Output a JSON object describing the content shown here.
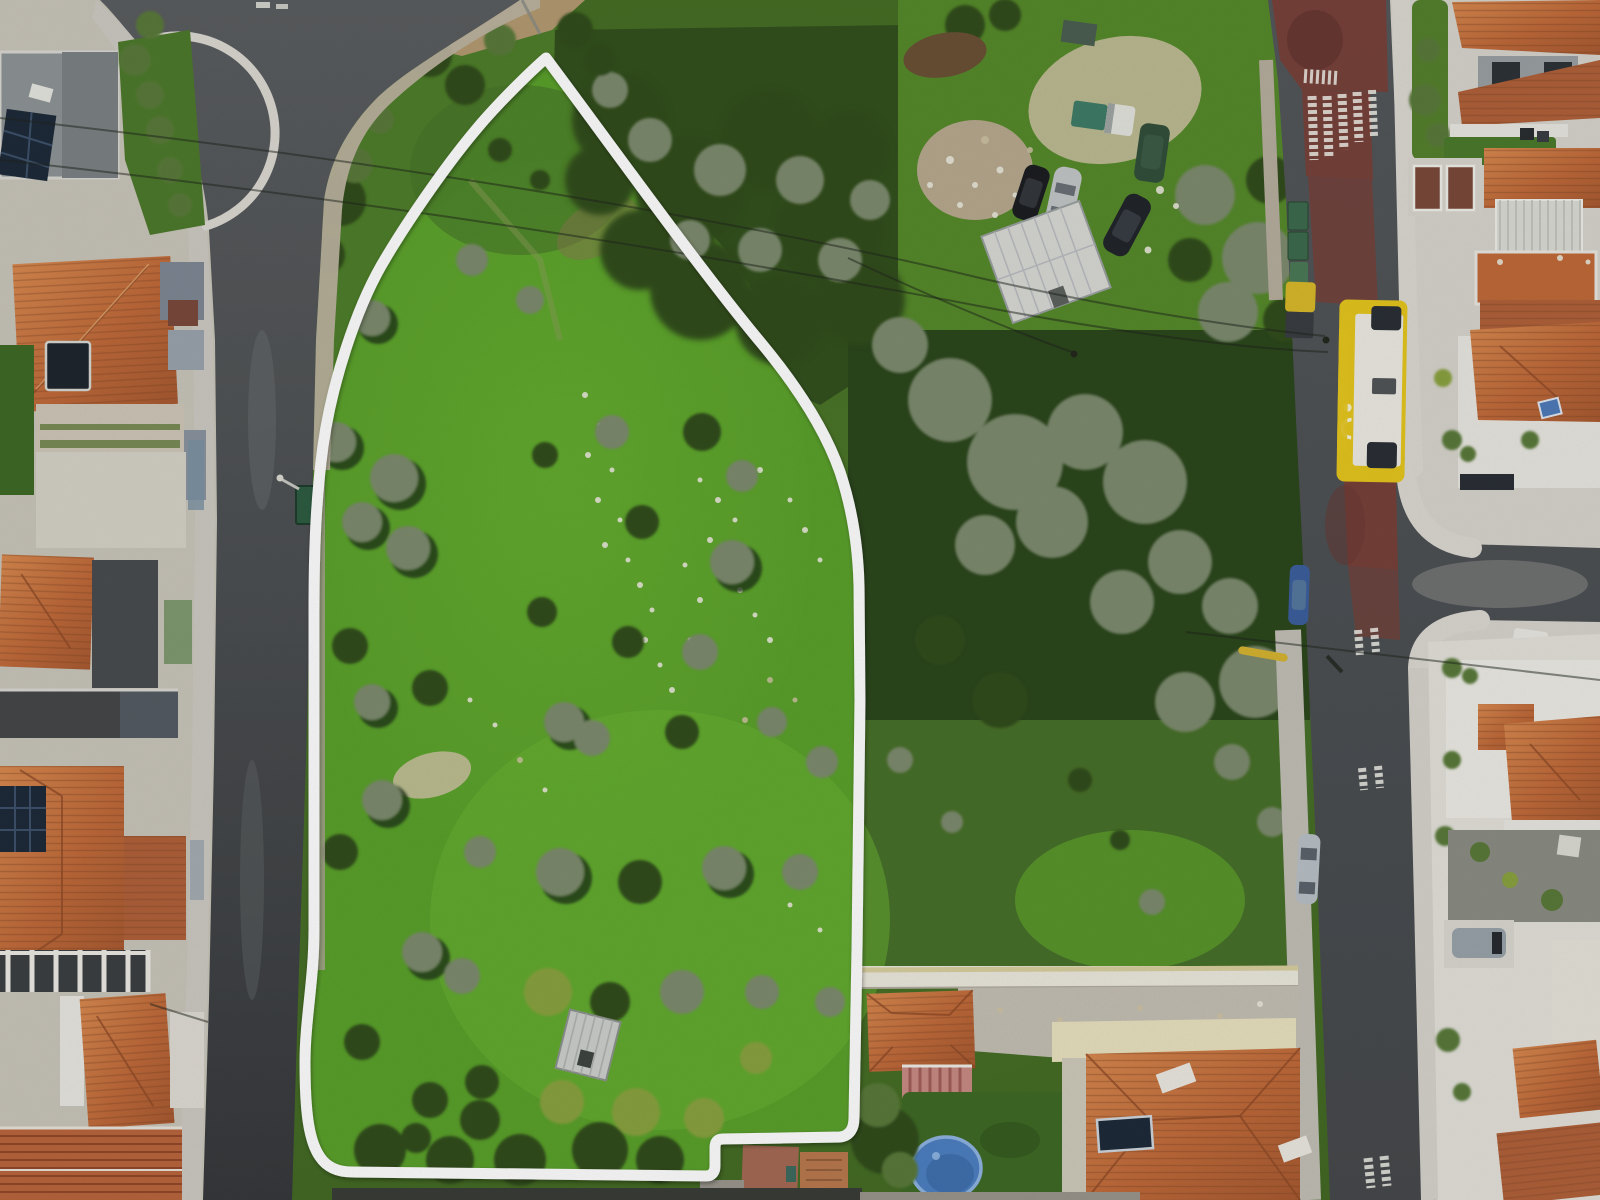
{
  "image": {
    "kind": "aerial-drone-photograph",
    "description": "Top-down aerial photo of a residential neighborhood with a large green land plot outlined by a thick white property-boundary overlay, flanked by two streets",
    "width_px": 1600,
    "height_px": 1200
  },
  "overlay": {
    "type": "property-boundary-outline",
    "color": "#ffffff",
    "stroke_width": 11
  },
  "colors": {
    "outline": "#ffffff",
    "plot_grass": "#5ba12c",
    "grass_dark": "#3f6322",
    "veg_dense": "#2c471d",
    "bus_lane_red": "#7c4038",
    "sidewalk": "#dcd9d2",
    "gravel": "#bdb4a0",
    "roof_orange": "#c8743f",
    "wall_white": "#e9e7e1",
    "bus_yellow": "#e5c51e",
    "pool_blue": "#4d80c2",
    "solar_panel": "#1f2b3a",
    "dirt_tan": "#b49a72"
  },
  "scene_objects": {
    "plot": "large grassy parcel with olive trees, rocks and a small ruined shed, outlined in white",
    "left_street": "asphalt street running vertically along the left side",
    "right_street": "asphalt street with dark-red painted bus lane, white road markings and a parked yellow bus",
    "junkyard": "dirt yard at top right with five parked cars, debris piles and a light corrugated shed roof",
    "vehicles": [
      "yellow bus",
      "white van",
      "dark car",
      "blue car",
      "silver car",
      "yellow truck",
      "black car",
      "dark green SUV",
      "silver SUV",
      "dark sedan",
      "white truck"
    ],
    "pool": "blue oval above-ground pool in bottom-center backyard",
    "houses": "white-walled houses with orange tiled roofs on left, right and bottom margins; some with rooftop solar panels",
    "road_text_legible": false
  }
}
